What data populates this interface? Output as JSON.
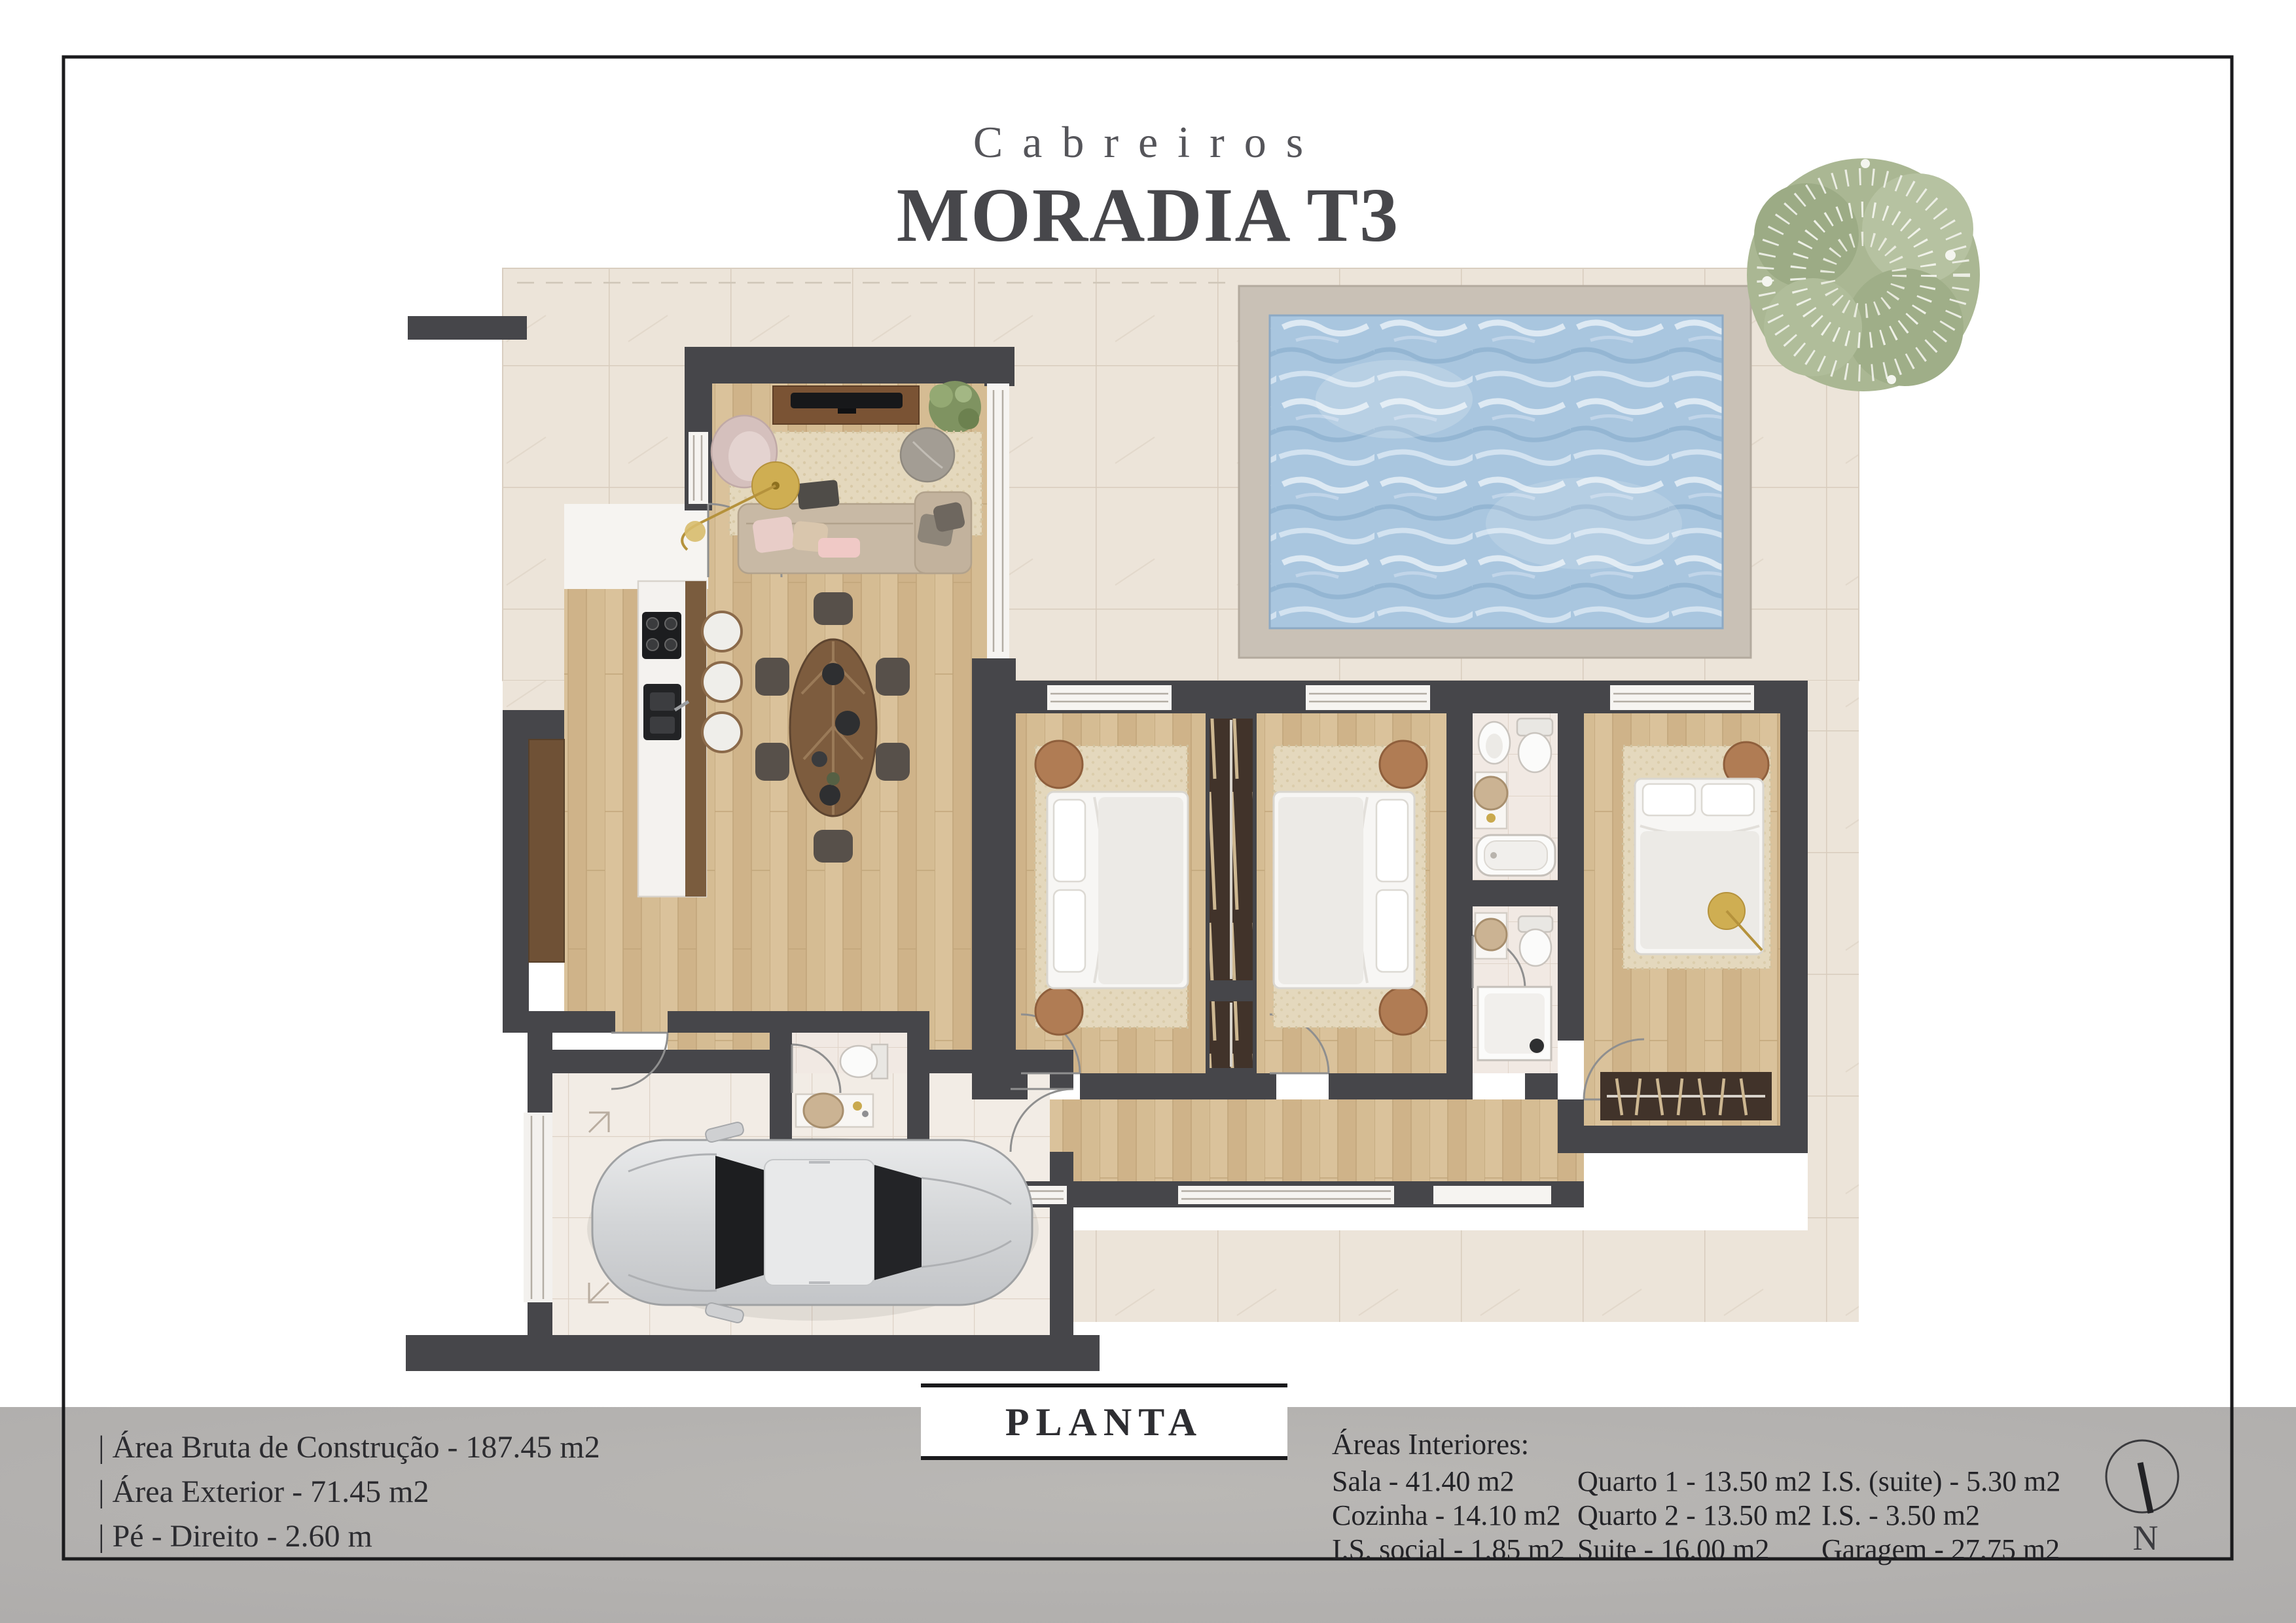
{
  "header": {
    "brand": "Cabreiros",
    "title": "MORADIA T3"
  },
  "plan": {
    "label": "PLANTA",
    "compass_letter": "N"
  },
  "specs": {
    "items": [
      "| Área Bruta de Construção - 187.45 m2",
      "| Área Exterior - 71.45 m2",
      "| Pé - Direito - 2.60 m"
    ]
  },
  "areas": {
    "heading": "Áreas Interiores:",
    "col1": [
      "Sala - 41.40 m2",
      "Cozinha - 14.10 m2",
      "I.S. social - 1.85 m2"
    ],
    "col2": [
      "Quarto 1 - 13.50 m2",
      "Quarto 2 - 13.50 m2",
      "Suite - 16.00 m2"
    ],
    "col3": [
      "I.S. (suite) - 5.30 m2",
      "I.S. - 3.50 m2",
      "Garagem - 27.75 m2"
    ]
  },
  "colors": {
    "wall": "#46464a",
    "wood_floor": "#d5bc93",
    "terrace_tile": "#ece4d9",
    "garage_tile": "#f2ece5",
    "bath_tile": "#f1e9e3",
    "pool_deck": "#c9c1b6",
    "pool_water": "#a9c6df",
    "rug": "#e4d8bd",
    "walnut": "#6f5136",
    "band_gray": "#b3b1ae",
    "text_dark": "#2c2c30",
    "gold": "#cfae52"
  },
  "icons": [
    "north-arrow-icon",
    "tree-icon",
    "pool-icon",
    "car-icon",
    "bed-icon",
    "sofa-icon",
    "tv-icon",
    "dining-table-icon",
    "kitchen-island-icon",
    "toilet-icon",
    "sink-icon",
    "bathtub-icon",
    "shower-icon",
    "wardrobe-icon",
    "door-arc-icon",
    "plant-icon"
  ]
}
